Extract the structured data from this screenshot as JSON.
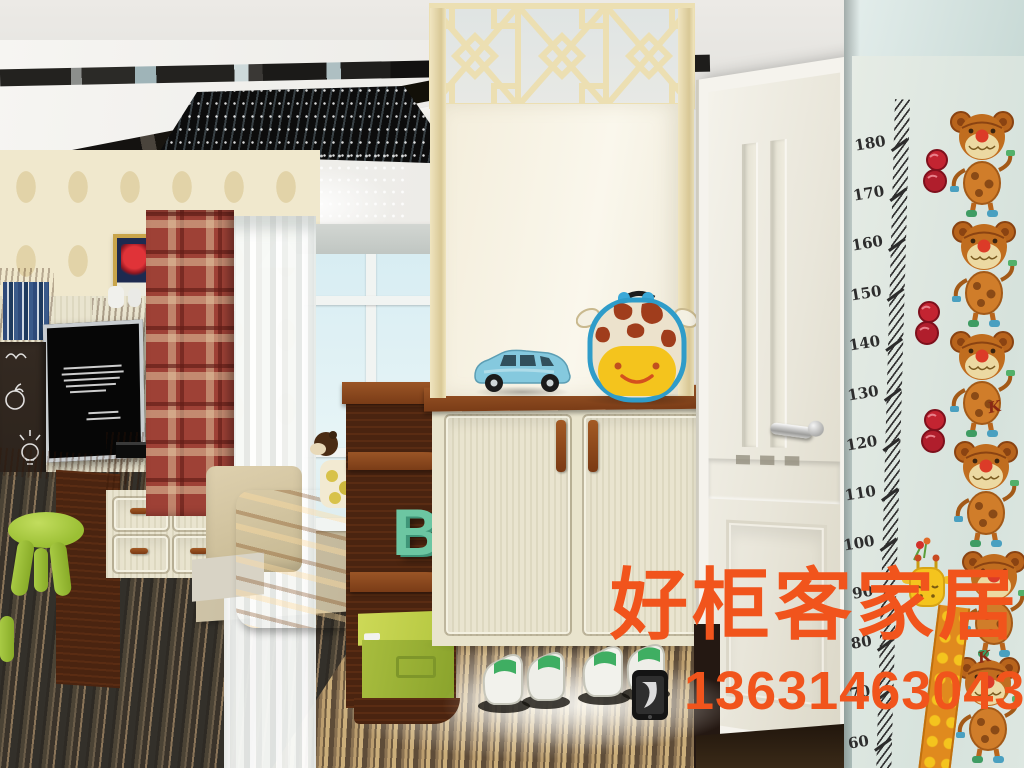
{
  "watermark": {
    "brand_text": "好柜客家居",
    "phone_number": "13631463043",
    "text_color": "#f1541c"
  },
  "height_chart": {
    "unit_labels": [
      "180",
      "170",
      "160",
      "150",
      "140",
      "130",
      "120",
      "110",
      "100",
      "90",
      "80",
      "70",
      "60"
    ],
    "doodle_letter": "K"
  },
  "shelf": {
    "letter": "B"
  },
  "icons": {
    "phone": "smartphone-icon"
  },
  "colors": {
    "right_wall": "#c9dad6",
    "door": "#efece2",
    "cabinet_cream": "#e9e4cd",
    "wood_brown": "#7a3c17",
    "curtain_red": "#9e4136",
    "wallpaper_cream": "#f0e8cd",
    "stool_green": "#9bbf34",
    "letter_green": "#6cc6a2",
    "blanket_orange": "#e08a24",
    "backpack_blue": "#2f9cc9",
    "watermark_orange": "#f1541c",
    "floor_dark": "#3a332a"
  }
}
